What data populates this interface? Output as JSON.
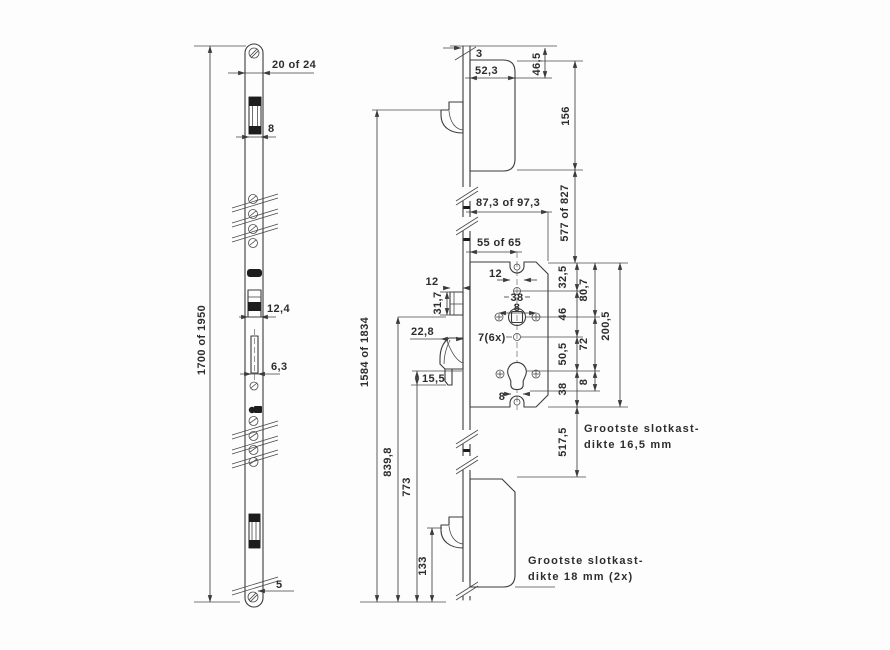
{
  "left_view": {
    "total_length": "1700 of 1950",
    "plate_width": "20 of 24",
    "latch_width": "8",
    "bolt_width": "12,4",
    "slot_width": "6,3",
    "end_offset": "5"
  },
  "right_view": {
    "plate_thickness": "3",
    "case_width": "52,3",
    "dim_46_5": "46,5",
    "dim_156": "156",
    "case_depth": "87,3 of 97,3",
    "dim_577": "577 of 827",
    "backset": "55 of 65",
    "notch_width": "12",
    "latch_stickout": "12",
    "latch_height": "31,7",
    "hook_stickout": "22,8",
    "hook_step": "15,5",
    "hole_spacing_38": "38",
    "spindle_size_8": "8",
    "hole_count": "7(6x)",
    "cyl_width_8": "8",
    "dim_32_5": "32,5",
    "dim_46": "46",
    "dim_50_5": "50,5",
    "dim_38": "38",
    "dim_80_7": "80,7",
    "dim_72": "72",
    "dim_8": "8",
    "case_height": "200,5",
    "dim_517_5": "517,5",
    "total_length": "1584 of 1834",
    "dim_839_8": "839,8",
    "dim_773": "773",
    "dim_133": "133"
  },
  "notes": {
    "note1_line1": "Grootste slotkast-",
    "note1_line2": "dikte 16,5 mm",
    "note2_line1": "Grootste slotkast-",
    "note2_line2": "dikte 18 mm (2x)"
  }
}
